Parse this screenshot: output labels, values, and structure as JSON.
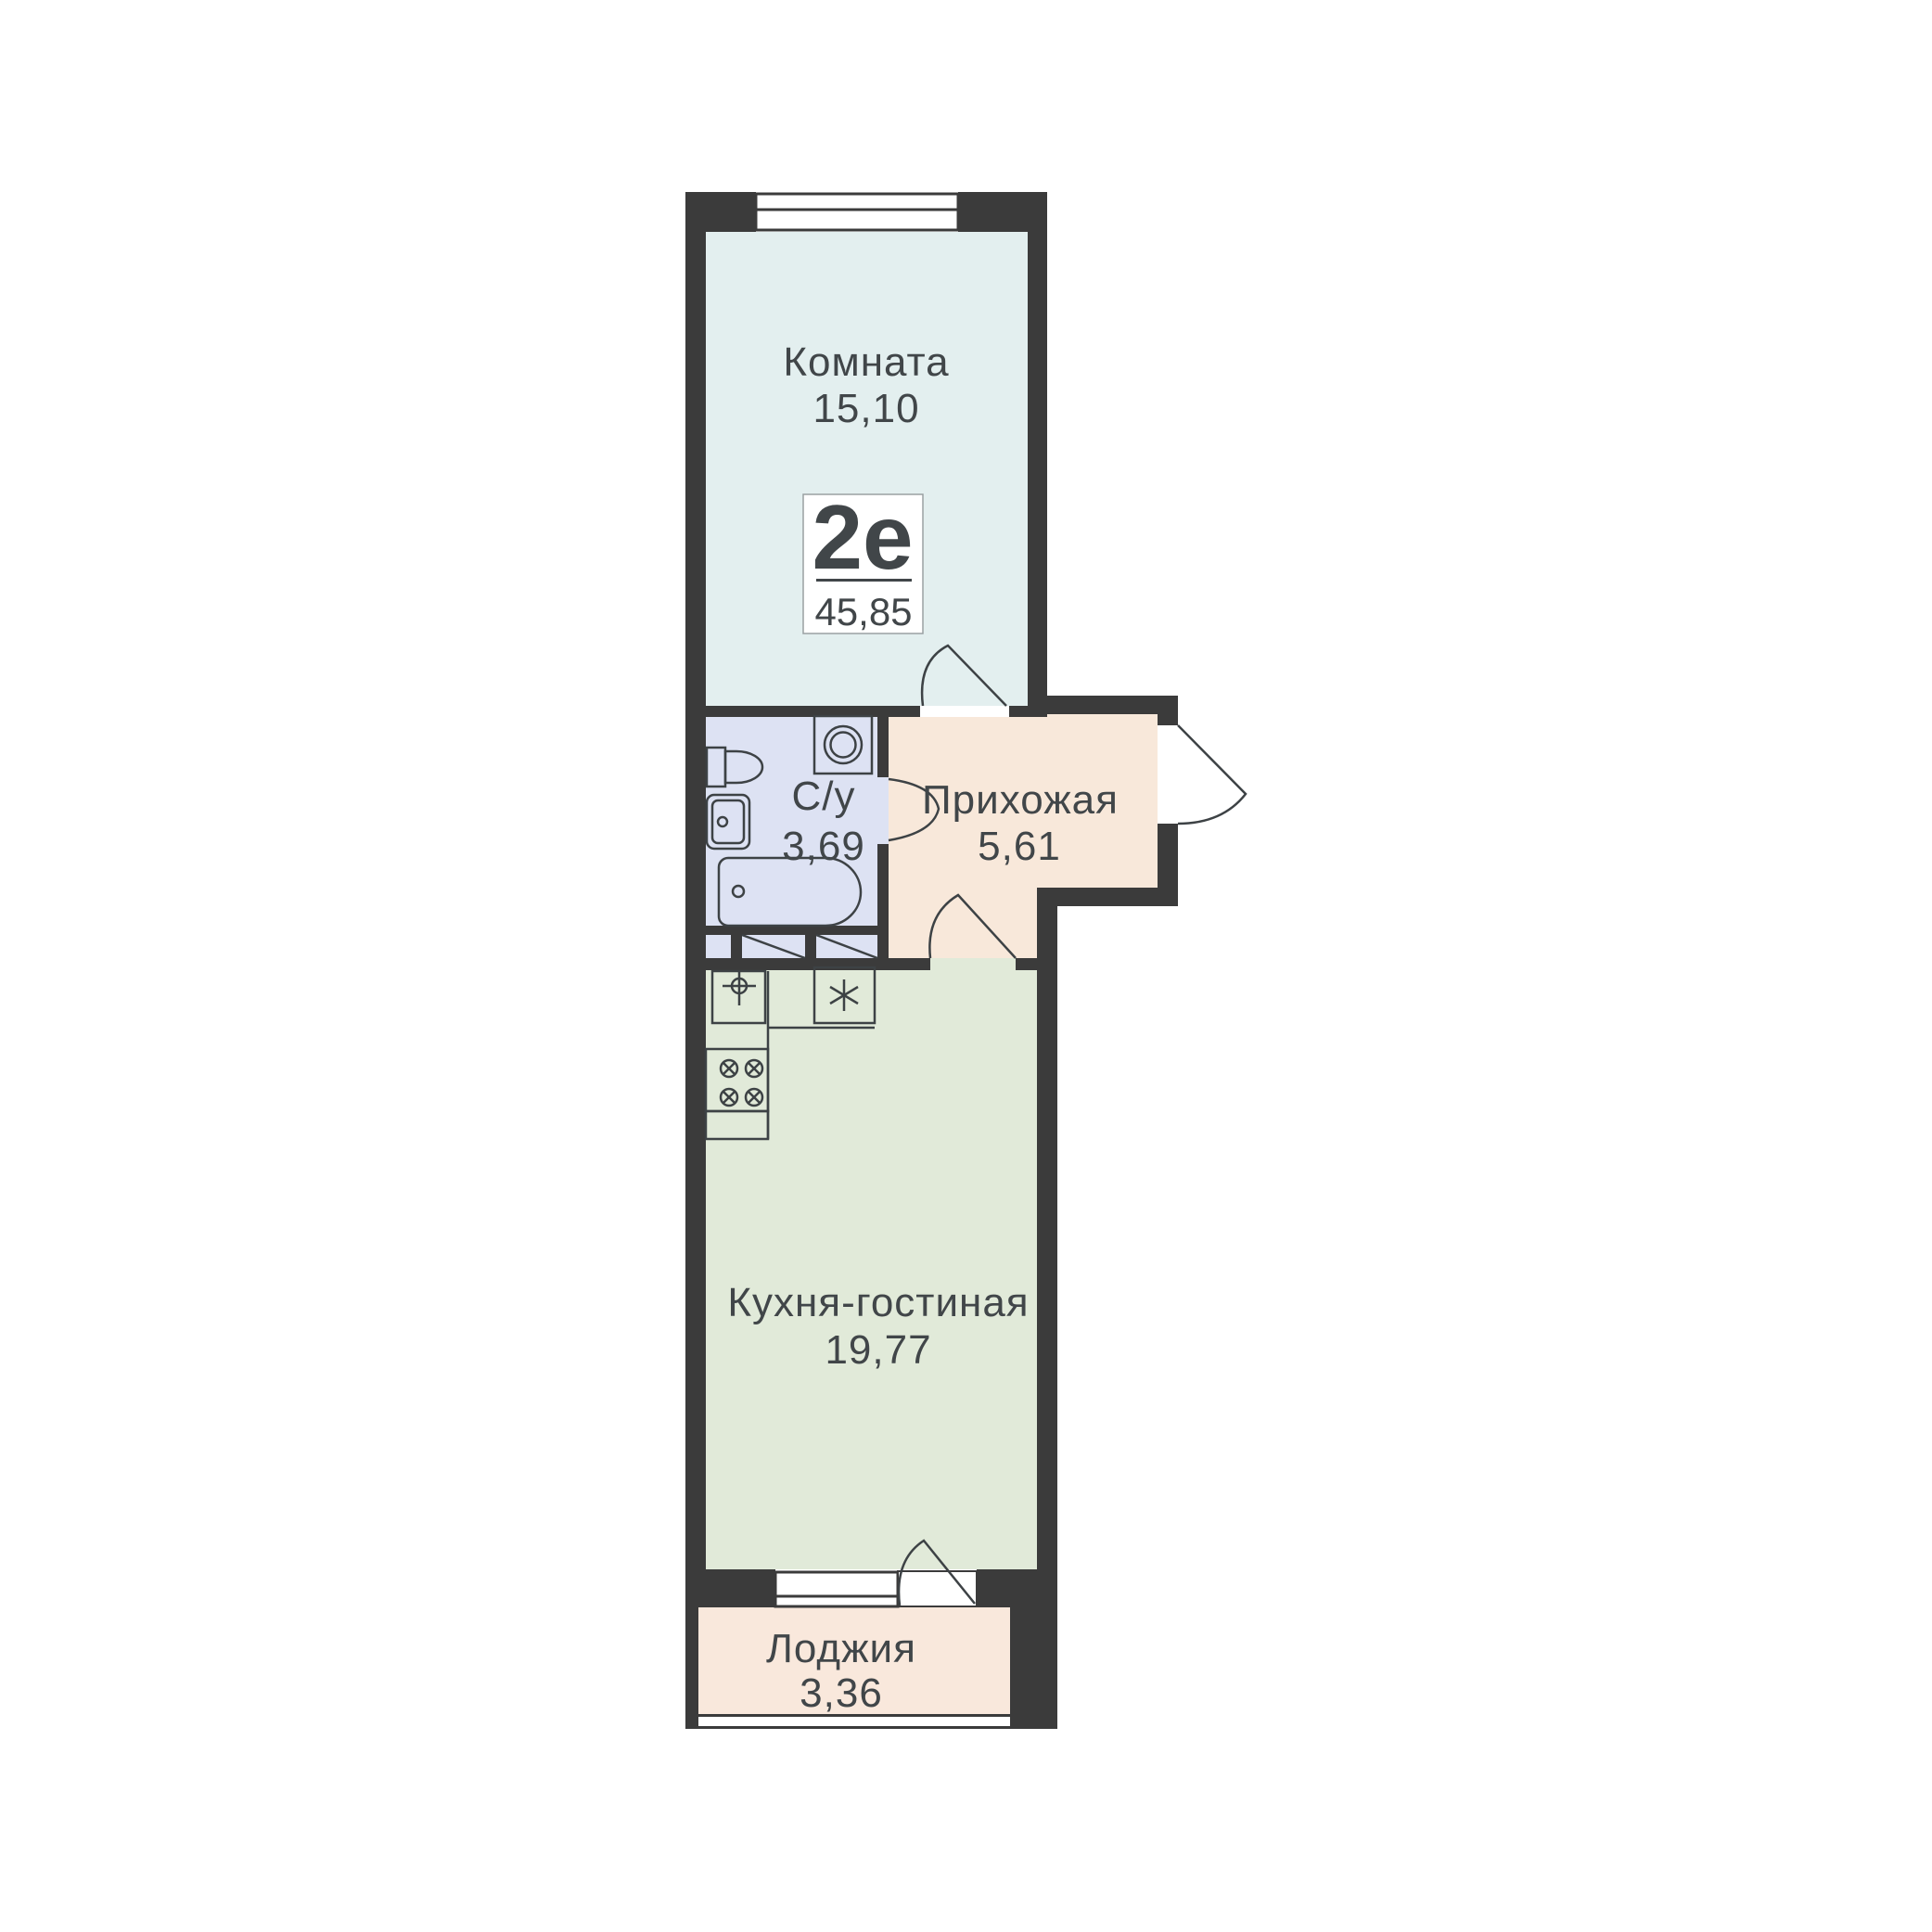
{
  "apartment": {
    "type_label": "2е",
    "total_area": "45,85"
  },
  "rooms": [
    {
      "name": "Комната",
      "area": "15,10"
    },
    {
      "name": "С/у",
      "area": "3,69"
    },
    {
      "name": "Прихожая",
      "area": "5,61"
    },
    {
      "name": "Кухня-гостиная",
      "area": "19,77"
    },
    {
      "name": "Лоджия",
      "area": "3,36"
    }
  ],
  "icons": {
    "bathroom": [
      "toilet-icon",
      "sink-icon",
      "washing-machine-icon",
      "bathtub-icon"
    ],
    "kitchen": [
      "kitchen-sink-icon",
      "faucet-icon",
      "stove-burners-icon",
      "fridge-snowflake-icon"
    ],
    "doors": [
      "door-swing-arc"
    ],
    "windows": [
      "window-glazing"
    ]
  },
  "colors": {
    "wall": "#3b3b3b",
    "line": "#3d4245",
    "text": "#414649",
    "room": "#e3efef",
    "bathroom": "#dde2f3",
    "hallway": "#f8e8da",
    "kitchen": "#e1ead9",
    "loggia": "#f9e8dc",
    "badge_border": "#9aa0a2",
    "background": "#ffffff"
  }
}
